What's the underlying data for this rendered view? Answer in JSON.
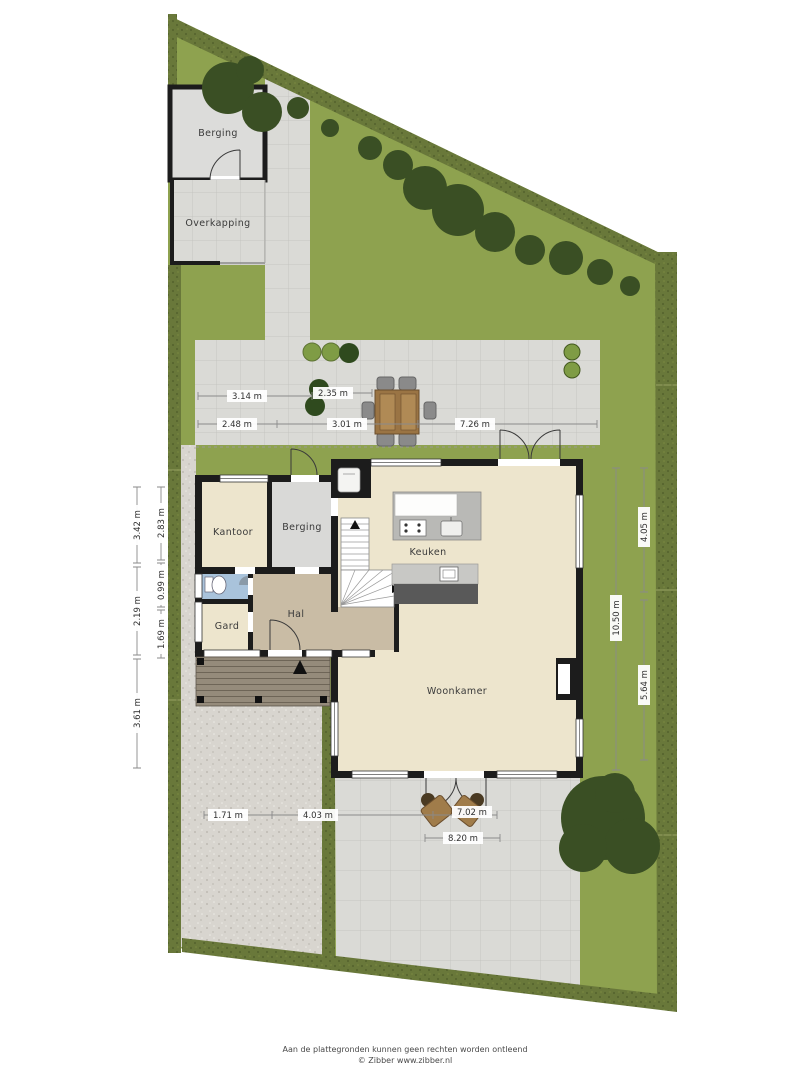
{
  "plan": {
    "type": "site-floorplan",
    "rooms": {
      "kantoor": "Kantoor",
      "berging_house": "Berging",
      "keuken": "Keuken",
      "hal": "Hal",
      "gard": "Gard",
      "woonkamer": "Woonkamer"
    },
    "outbuildings": {
      "berging_shed": "Berging",
      "overkapping": "Overkapping"
    },
    "dims": {
      "top_row1": [
        "3.14 m",
        "2.35 m"
      ],
      "top_row2": [
        "2.48 m",
        "3.01 m",
        "7.26 m"
      ],
      "bottom_row": [
        "1.71 m",
        "4.03 m",
        "7.02 m",
        "8.20 m"
      ],
      "left_outer": [
        "3.42 m",
        "2.19 m",
        "3.61 m"
      ],
      "left_inner": [
        "2.83 m",
        "0.99 m",
        "1.69 m"
      ],
      "right_outer": [
        "4.05 m",
        "5.64 m"
      ],
      "right_inner": [
        "10.50 m"
      ]
    },
    "footer": {
      "disclaimer": "Aan de plattegronden kunnen geen rechten worden ontleend",
      "credit": "© Zibber www.zibber.nl"
    }
  },
  "colors": {
    "lawn": "#8EA24F",
    "hedge": "#69783A",
    "hedgedark": "#57652E",
    "tree": "#3A4F24",
    "bushlight": "#7F9C45",
    "tile": "#DADAD6",
    "tileline": "#C5C5C1",
    "gravel": "#D8D5CF",
    "wall": "#1C1C1C",
    "cream": "#EDE5CD",
    "hallfloor": "#C9BCA5",
    "storage": "#D9D9D7",
    "toiletblue": "#A9C3DB",
    "wood": "#9A7444",
    "deck": "#958B7B",
    "chairgray": "#8A8A8A"
  }
}
